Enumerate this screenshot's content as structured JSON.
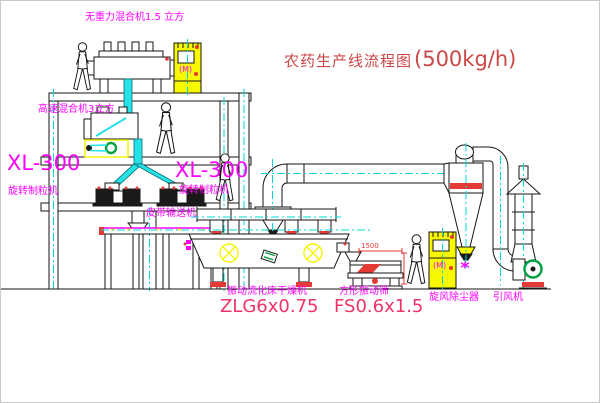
{
  "title": {
    "prefix": "农药生产线流程图",
    "capacity": "(500kg/h)"
  },
  "labels": {
    "roof_mixer": "无重力混合机1.5 立方",
    "floor2_mixer": "高速混合机3立方",
    "granulator_left_model": "XL-300",
    "granulator_left_name": "旋转制粒机",
    "granulator_mid_model": "XL-300",
    "granulator_mid_name": "旋转制粒机",
    "belt_conveyor": "皮带输送机",
    "dryer_name": "振动流化床干燥机",
    "dryer_model": "ZLG6x0.75",
    "sieve_name": "方形振动筛",
    "sieve_model": "FS0.6x1.5",
    "cyclone_name": "旋风除尘器",
    "fan_name": "引风机",
    "dim_1500": "1500",
    "cabinet_marks": "(M)",
    "elevator_marks": "(M)"
  },
  "colors": {
    "label_magenta": "#FF00FF",
    "model_pink": "#EE3366",
    "title_red": "#CC4747",
    "line_black": "#161616",
    "pipe_cyan": "#25E2E8",
    "centerline_cyan": "#00D8DC",
    "equipment_yellow": "#F8F800",
    "flange_red": "#E53935",
    "fan_green": "#00A040",
    "background": "#FFFFFF"
  }
}
